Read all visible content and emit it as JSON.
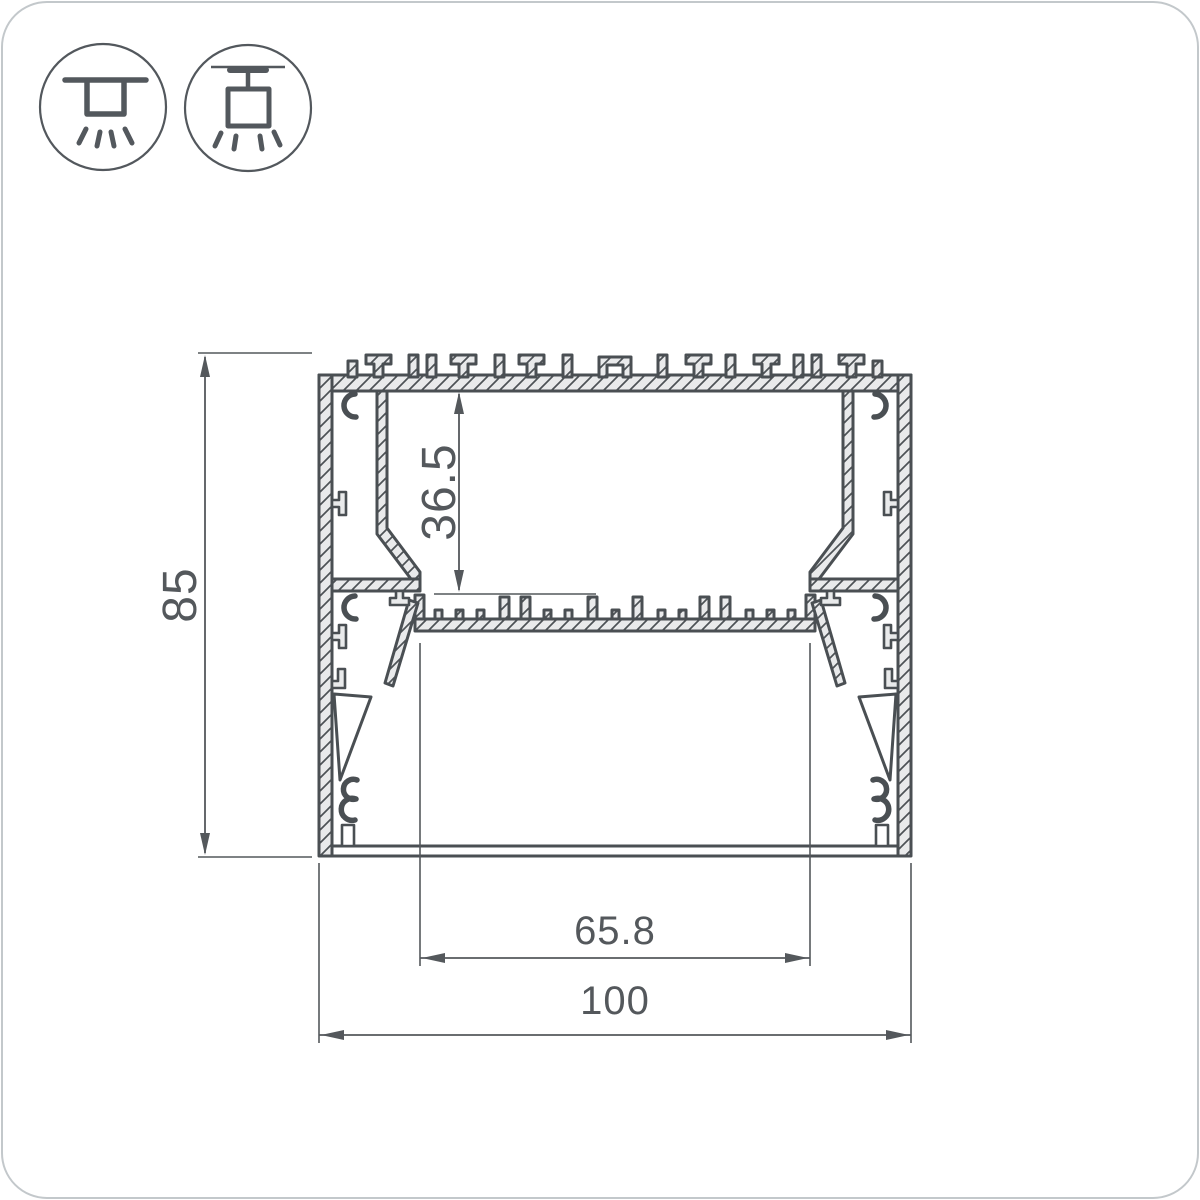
{
  "drawing": {
    "title": "aluminum-led-profile-cross-section",
    "colors": {
      "line": "#4a4f53",
      "material_fill": "#e9eaeb",
      "dimension": "#54585c",
      "background": "#ffffff",
      "corner_border": "#c3c8cb"
    },
    "icons": [
      {
        "name": "surface-mount-icon"
      },
      {
        "name": "pendant-mount-icon"
      }
    ],
    "dimensions": {
      "height_total": "85",
      "inner_height": "36.5",
      "inner_width": "65.8",
      "width_total": "100"
    }
  }
}
